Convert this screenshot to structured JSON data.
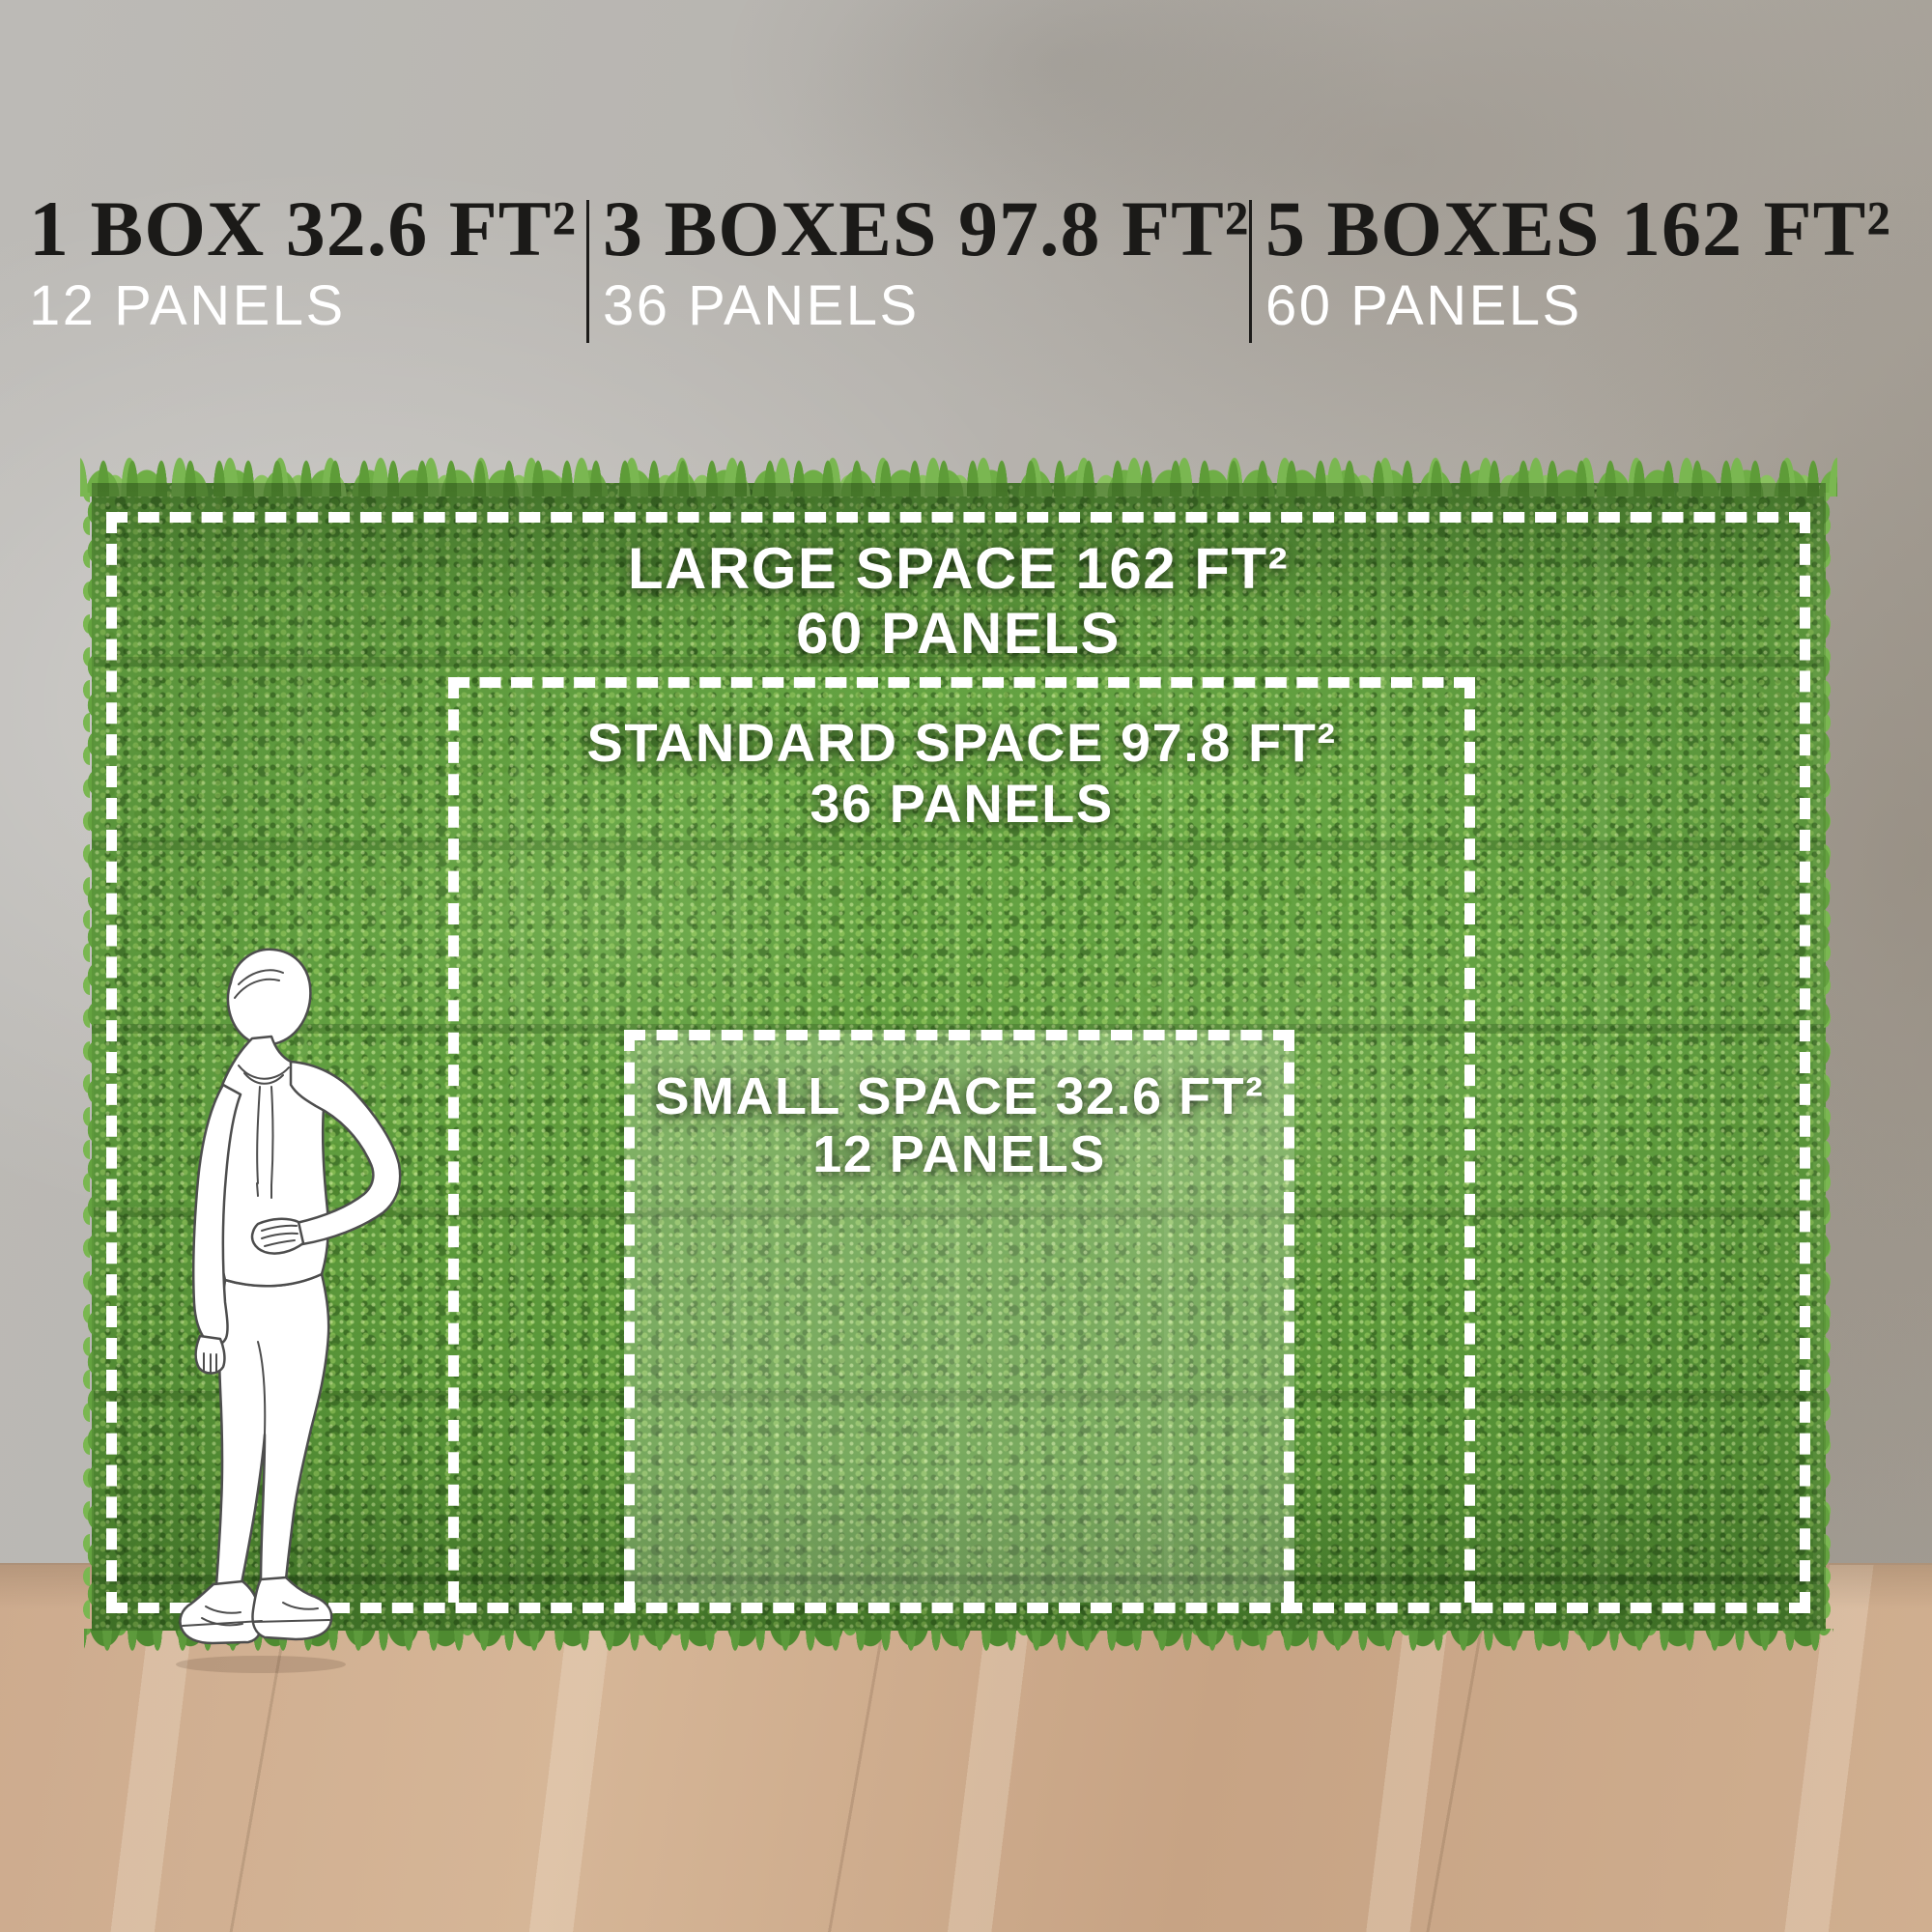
{
  "header": {
    "options": [
      {
        "title": "1 BOX 32.6 FT²",
        "subtitle": "12 PANELS"
      },
      {
        "title": "3 BOXES 97.8 FT²",
        "subtitle": "36 PANELS"
      },
      {
        "title": "5 BOXES 162 FT²",
        "subtitle": "60 PANELS"
      }
    ]
  },
  "zones": {
    "large": {
      "line1": "LARGE SPACE 162 FT²",
      "line2": "60 PANELS"
    },
    "standard": {
      "line1": "STANDARD SPACE 97.8 FT²",
      "line2": "36 PANELS"
    },
    "small": {
      "line1": "SMALL SPACE 32.6 FT²",
      "line2": "12 PANELS"
    }
  },
  "colors": {
    "heading_text": "#1b1a18",
    "panels_text": "#ffffff",
    "dash_white": "#ffffff",
    "hedge_green": "#67a744",
    "wall_gray": "#b5b2ad",
    "floor_wood": "#cfae90"
  }
}
